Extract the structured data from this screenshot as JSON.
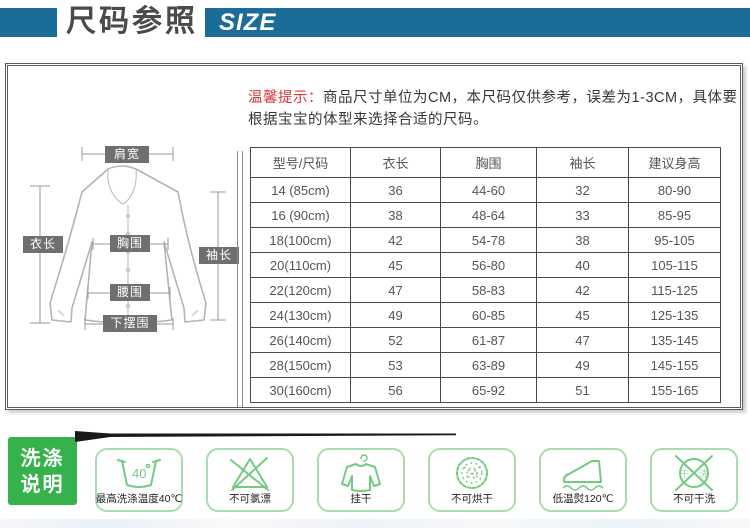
{
  "header": {
    "title": "尺码参照",
    "size_label": "SIZE"
  },
  "notice": {
    "prefix": "温馨提示：",
    "text": "商品尺寸单位为CM，本尺码仅供参考，误差为1-3CM，具体要根据宝宝的体型来选择合适的尺码。"
  },
  "diagram": {
    "labels": [
      "肩宽",
      "衣长",
      "胸围",
      "袖长",
      "腰围",
      "下摆围"
    ]
  },
  "size_table": {
    "headers": [
      "型号/尺码",
      "衣长",
      "胸围",
      "袖长",
      "建议身高"
    ],
    "rows": [
      [
        "14 (85cm)",
        "36",
        "44-60",
        "32",
        "80-90"
      ],
      [
        "16 (90cm)",
        "38",
        "48-64",
        "33",
        "85-95"
      ],
      [
        "18(100cm)",
        "42",
        "54-78",
        "38",
        "95-105"
      ],
      [
        "20(110cm)",
        "45",
        "56-80",
        "40",
        "105-115"
      ],
      [
        "22(120cm)",
        "47",
        "58-83",
        "42",
        "115-125"
      ],
      [
        "24(130cm)",
        "49",
        "60-85",
        "45",
        "125-135"
      ],
      [
        "26(140cm)",
        "52",
        "61-87",
        "47",
        "135-145"
      ],
      [
        "28(150cm)",
        "53",
        "63-89",
        "49",
        "145-155"
      ],
      [
        "30(160cm)",
        "56",
        "65-92",
        "51",
        "155-165"
      ]
    ]
  },
  "wash": {
    "title_line1": "洗涤",
    "title_line2": "说明",
    "items": [
      {
        "icon": "wash-basin-40-icon",
        "label": "最高洗涤温度40℃"
      },
      {
        "icon": "no-bleach-icon",
        "label": "不可氯漂"
      },
      {
        "icon": "hang-dry-icon",
        "label": "挂干"
      },
      {
        "icon": "no-tumble-dry-icon",
        "label": "不可烘干"
      },
      {
        "icon": "iron-low-temp-icon",
        "label": "低温熨120℃"
      },
      {
        "icon": "no-dry-clean-icon",
        "label": "不可干洗"
      }
    ],
    "dry_clean_chars": {
      "left": "干",
      "right": "洗"
    },
    "basin_temp": "40"
  },
  "colors": {
    "accent": "#1b6c99",
    "notice-red": "#d93a3a",
    "wash-green": "#35b24b",
    "icon-green": "#74ca82",
    "card-border-green": "#a8dcb0"
  }
}
